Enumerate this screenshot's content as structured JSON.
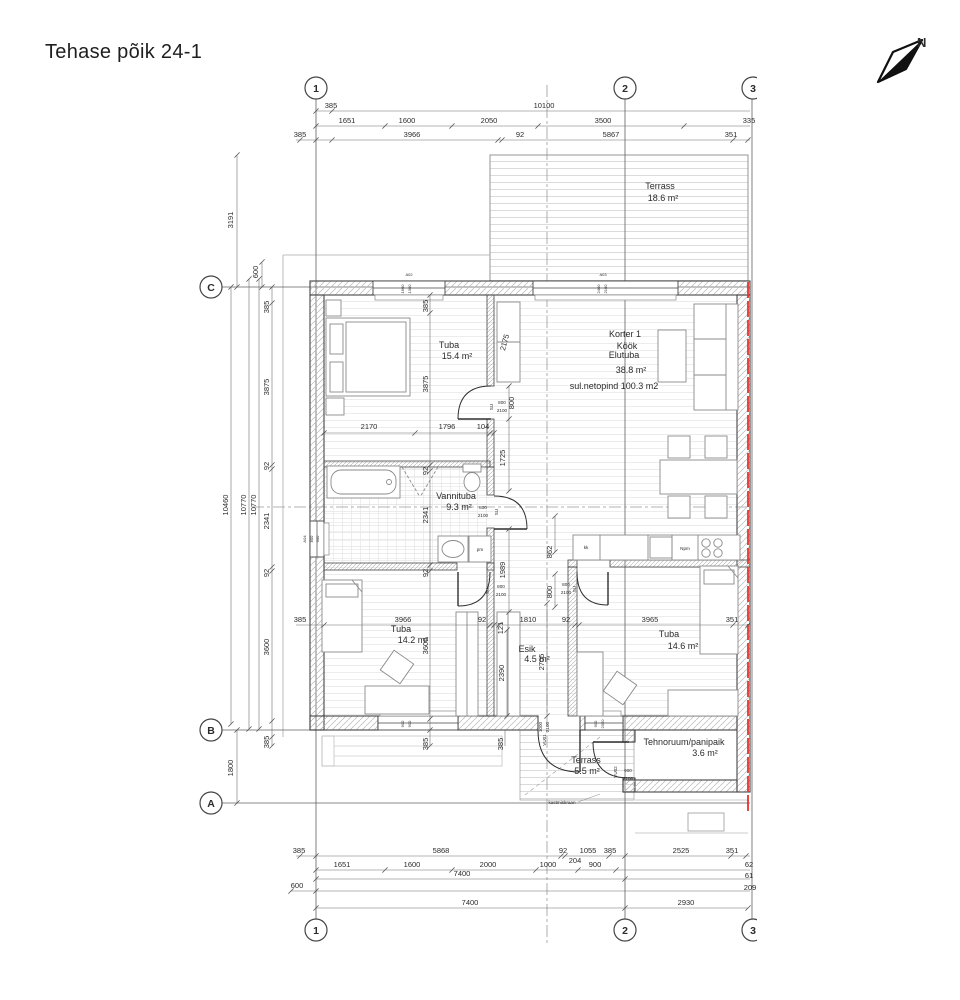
{
  "title": "Tehase põik 24-1",
  "north_label": "N",
  "colors": {
    "wall_line": "#454545",
    "thin_line": "#8a8a8a",
    "hatch": "#b8b8b8",
    "deck": "#d4d4d4",
    "red_marking": "#e8322a",
    "dim_text": "#2b2b2b"
  },
  "grid": {
    "cols": [
      "1",
      "2",
      "3"
    ],
    "rows": [
      "C",
      "B",
      "A"
    ]
  },
  "rooms": {
    "terrace_top": {
      "name": "Terrass",
      "area": "18.6 m²"
    },
    "bedroom1": {
      "name": "Tuba",
      "area": "15.4 m²"
    },
    "living": {
      "unit": "Korter 1",
      "line1": "Köök",
      "line2": "Elutuba",
      "area": "38.8 m²",
      "net": "sul.netopind 100.3 m2"
    },
    "bathroom": {
      "name": "Vannituba",
      "area": "9.3 m²"
    },
    "bedroom2": {
      "name": "Tuba",
      "area": "14.2 m²"
    },
    "hall": {
      "name": "Esik",
      "area": "4.5 m²"
    },
    "bedroom3": {
      "name": "Tuba",
      "area": "14.6 m²"
    },
    "terrace_south": {
      "name": "Terrass",
      "area": "5.5 m²"
    },
    "tech": {
      "name": "Tehnoruum/panipaik",
      "area": "3.6 m²"
    }
  },
  "fixtures": {
    "washing_machine": "pm",
    "kitchen_left": "kk",
    "sink": "Npm",
    "tap": "kastmiskraan"
  },
  "doors": {
    "su": {
      "code": "SU",
      "w": "800",
      "h": "2100"
    },
    "vu01": {
      "code": "VU01",
      "w": "1000",
      "h": "2100"
    },
    "vu02": {
      "code": "VU02",
      "w": "900",
      "h": "2100"
    }
  },
  "windows": {
    "a02": {
      "code": "A02",
      "a": "1600",
      "b": "1300"
    },
    "a03": {
      "code": "A03",
      "a": "2400",
      "b": "2100"
    },
    "a04": {
      "code": "A04",
      "a": "800",
      "b": "600"
    },
    "a01": {
      "code": "A01",
      "a": "900",
      "b": "900"
    },
    "aR": {
      "a": "900",
      "b": "2050"
    }
  },
  "dims": {
    "t0": [
      "385",
      "10100"
    ],
    "t1": [
      "1651",
      "1600",
      "2050",
      "3500",
      "335"
    ],
    "t2": [
      "385",
      "3966",
      "92",
      "5867",
      "351"
    ],
    "lv": [
      "3191",
      "600",
      "10460",
      "10770",
      "10770",
      "1800"
    ],
    "lc": [
      "385",
      "3875",
      "92",
      "2341",
      "92",
      "3600",
      "385"
    ],
    "ic": [
      "385",
      "3875",
      "92",
      "2341",
      "92",
      "3600",
      "385"
    ],
    "h1": [
      "2170",
      "1796",
      "104"
    ],
    "w1": [
      "800",
      "1725",
      "1989",
      "2175"
    ],
    "k1": [
      "862",
      "800"
    ],
    "mid": [
      "385",
      "3966",
      "92",
      "121",
      "1810",
      "92",
      "3965",
      "351"
    ],
    "hv": [
      "2390",
      "2705",
      "385"
    ],
    "b0": [
      "385",
      "5868",
      "92",
      "1055",
      "385",
      "2525",
      "351",
      "204"
    ],
    "b1": [
      "1651",
      "1600",
      "2000",
      "1000",
      "900",
      "62"
    ],
    "b2": [
      "7400",
      "61"
    ],
    "b3": [
      "600",
      "209"
    ],
    "b4": [
      "7400",
      "2930"
    ]
  }
}
